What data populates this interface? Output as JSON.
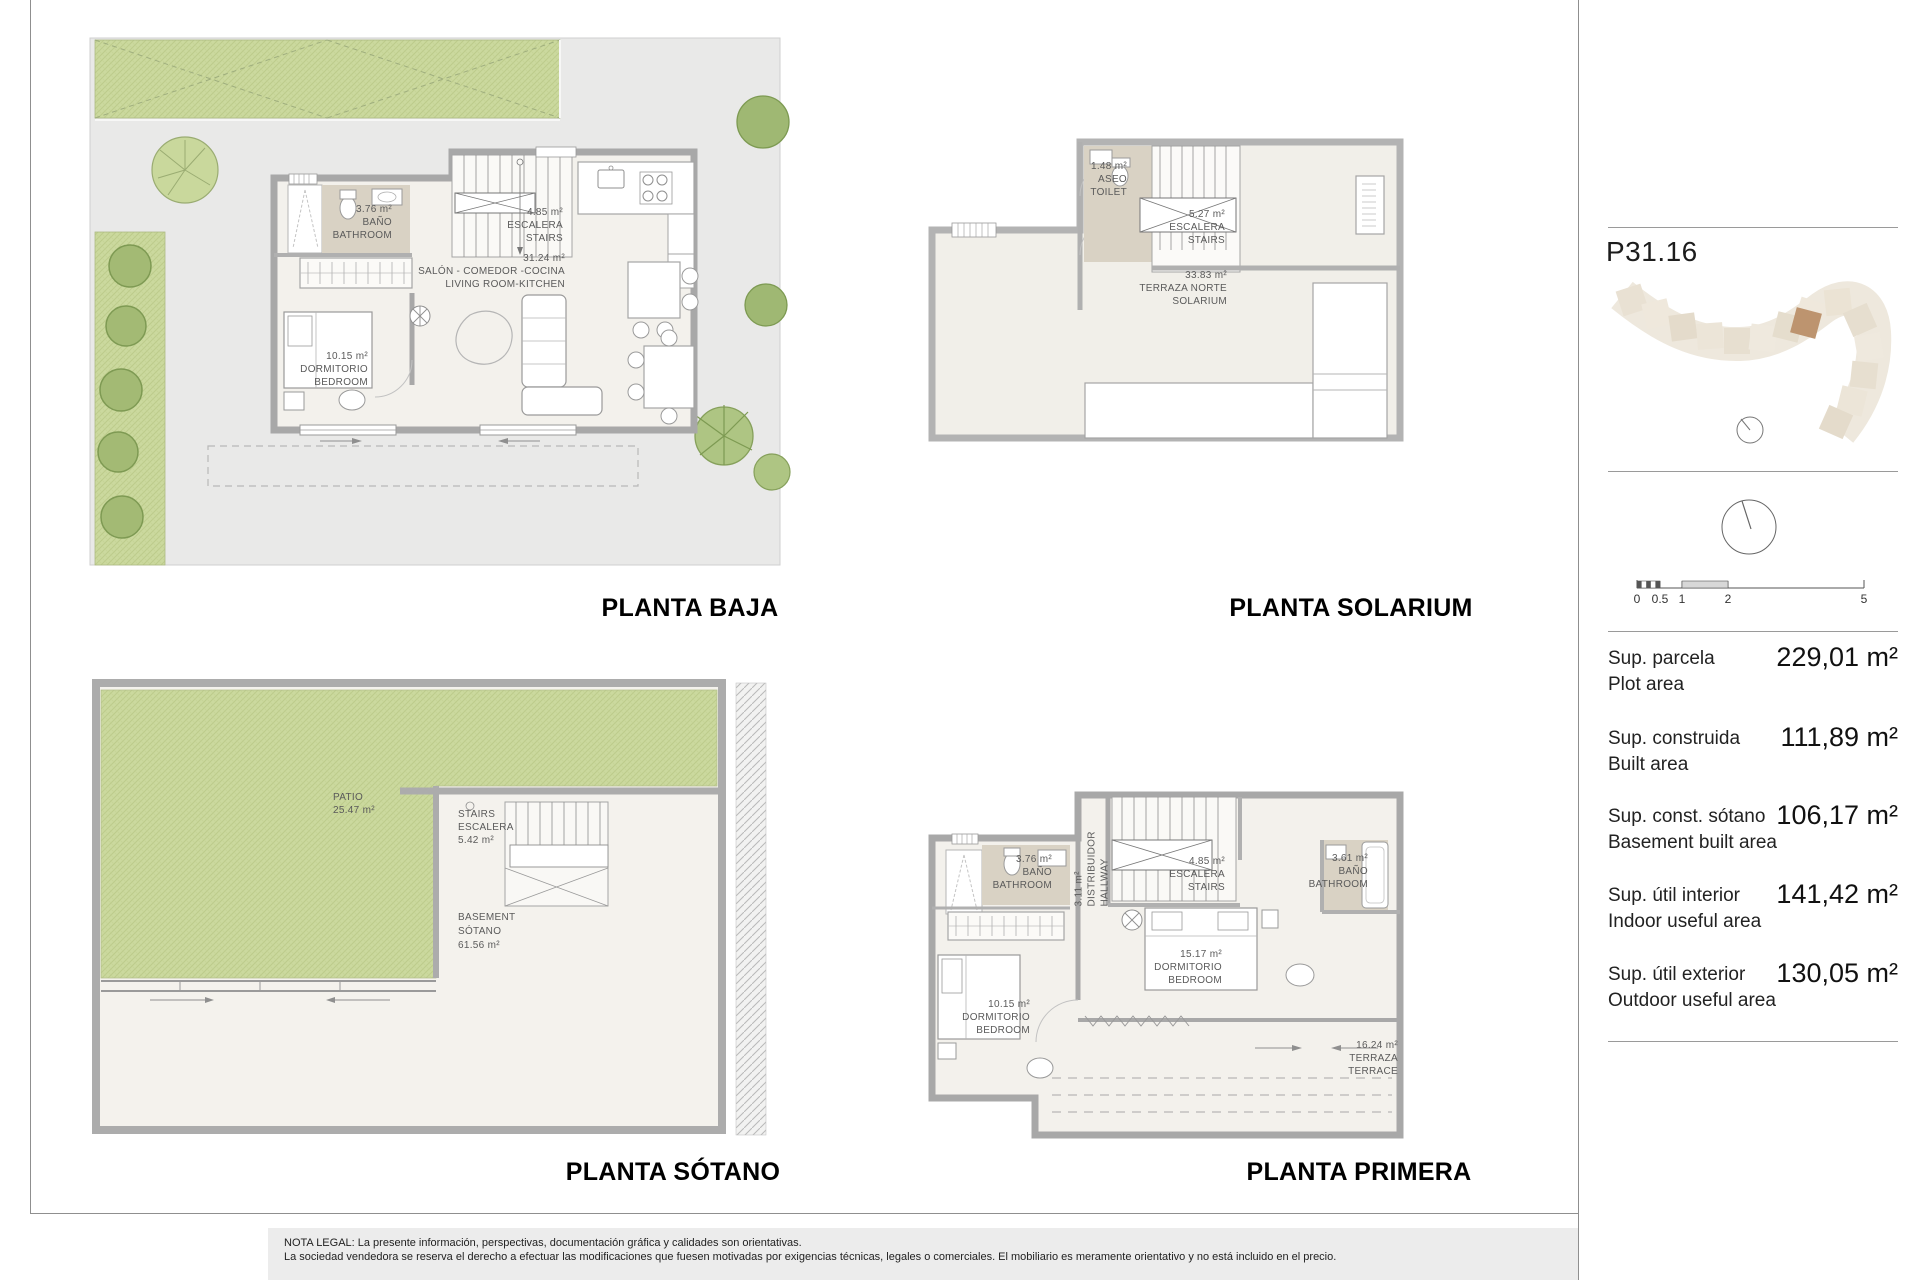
{
  "plans": {
    "baja": {
      "title": "PLANTA BAJA",
      "labels": [
        {
          "lines": [
            "3.76 m²",
            "BAÑO",
            "BATHROOM"
          ]
        },
        {
          "lines": [
            "4.85 m²",
            "ESCALERA",
            "STAIRS"
          ]
        },
        {
          "lines": [
            "31.24 m²",
            "SALÓN - COMEDOR -COCINA",
            "LIVING ROOM-KITCHEN"
          ]
        },
        {
          "lines": [
            "10.15 m²",
            "DORMITORIO",
            "BEDROOM"
          ]
        }
      ]
    },
    "solarium": {
      "title": "PLANTA SOLARIUM",
      "labels": [
        {
          "lines": [
            "1.48 m²",
            "ASEO",
            "TOILET"
          ]
        },
        {
          "lines": [
            "5.27 m²",
            "ESCALERA",
            "STAIRS"
          ]
        },
        {
          "lines": [
            "33.83 m²",
            "TERRAZA NORTE",
            "SOLARIUM"
          ]
        }
      ]
    },
    "sotano": {
      "title": "PLANTA SÓTANO",
      "labels": [
        {
          "lines": [
            "PATIO",
            "25.47 m²"
          ]
        },
        {
          "lines": [
            "STAIRS",
            "ESCALERA",
            "5.42 m²"
          ]
        },
        {
          "lines": [
            "BASEMENT",
            "SÓTANO",
            "61.56 m²"
          ]
        }
      ]
    },
    "primera": {
      "title": "PLANTA PRIMERA",
      "labels": [
        {
          "lines": [
            "3.76 m²",
            "BAÑO",
            "BATHROOM"
          ]
        },
        {
          "lines": [
            "3.11 m²",
            "DISTRIBUIDOR",
            "HALLWAY"
          ]
        },
        {
          "lines": [
            "4.85 m²",
            "ESCALERA",
            "STAIRS"
          ]
        },
        {
          "lines": [
            "15.17 m²",
            "DORMITORIO",
            "BEDROOM"
          ]
        },
        {
          "lines": [
            "10.15 m²",
            "DORMITORIO",
            "BEDROOM"
          ]
        },
        {
          "lines": [
            "3.61 m²",
            "BAÑO",
            "BATHROOM"
          ]
        },
        {
          "lines": [
            "16.24 m²",
            "TERRAZA",
            "TERRACE"
          ]
        }
      ]
    }
  },
  "sidebar": {
    "unit_code": "P31.16",
    "scale_ticks": [
      "0",
      "0.5",
      "1",
      "2",
      "5"
    ],
    "areas": [
      {
        "label_es": "Sup. parcela",
        "label_en": "Plot area",
        "value": "229,01 m²"
      },
      {
        "label_es": "Sup. construida",
        "label_en": "Built area",
        "value": "111,89 m²"
      },
      {
        "label_es": "Sup. const. sótano",
        "label_en": "Basement built area",
        "value": "106,17 m²"
      },
      {
        "label_es": "Sup. útil interior",
        "label_en": "Indoor useful area",
        "value": "141,42 m²"
      },
      {
        "label_es": "Sup. útil exterior",
        "label_en": "Outdoor useful area",
        "value": "130,05 m²"
      }
    ],
    "colors": {
      "highlight_unit": "#bd946f",
      "site_tile": "#ece5d8"
    }
  },
  "legal": {
    "line1": "NOTA LEGAL: La presente información, perspectivas, documentación gráfica y calidades son orientativas.",
    "line2": "La sociedad vendedora se reserva el derecho a efectuar las modificaciones que fuesen motivadas por exigencias técnicas, legales o comerciales. El mobiliario es meramente orientativo y no está incluido en el precio."
  }
}
